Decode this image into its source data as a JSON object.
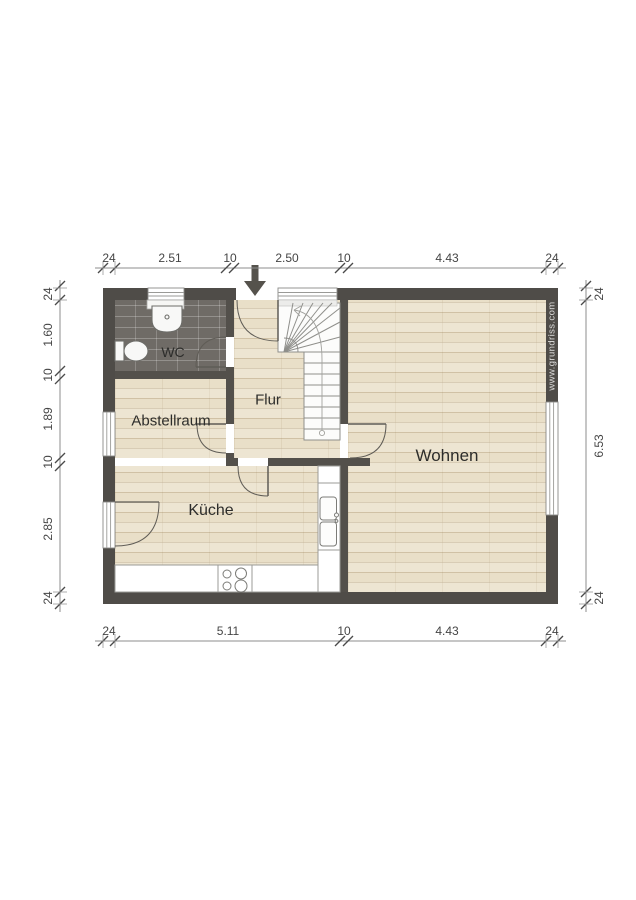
{
  "watermark": "www.grundriss.com",
  "rooms": {
    "wc": "WC",
    "flur": "Flur",
    "abstellraum": "Abstellraum",
    "kueche": "Küche",
    "wohnen": "Wohnen"
  },
  "dims": {
    "top": [
      "24",
      "2.51",
      "10",
      "2.50",
      "10",
      "4.43",
      "24"
    ],
    "left": [
      "24",
      "1.60",
      "10",
      "1.89",
      "10",
      "2.85",
      "24"
    ],
    "right": [
      "24",
      "6.53",
      "24"
    ],
    "bottom": [
      "24",
      "5.11",
      "10",
      "4.43",
      "24"
    ]
  },
  "colors": {
    "wall": "#4f4c48",
    "interior_wall": "#53504b",
    "wood_floor": "#e9dfc8",
    "wc_tile": "#6f6b66",
    "dimension_text": "#454545",
    "entrance_arrow": "#55524c"
  }
}
